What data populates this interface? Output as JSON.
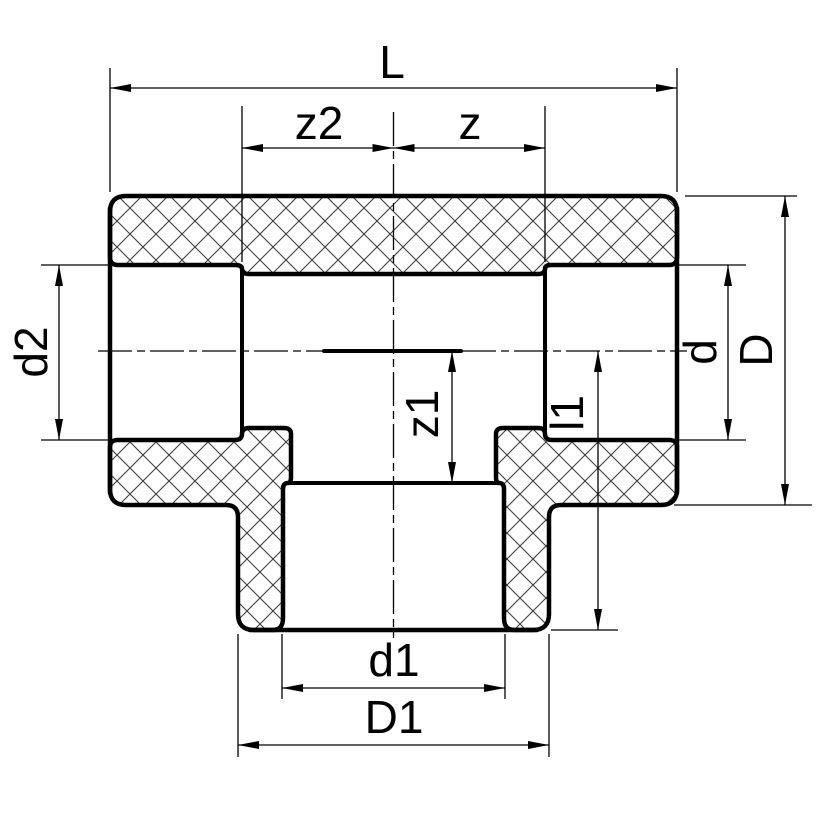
{
  "drawing": {
    "kind": "pipe-tee-fitting-cross-section",
    "colors": {
      "background": "#ffffff",
      "outline": "#000000",
      "hatch": "#3d3d3d"
    },
    "dimensions": {
      "L": {
        "label": "L"
      },
      "z2": {
        "label": "z2"
      },
      "z": {
        "label": "z"
      },
      "d2": {
        "label": "d2"
      },
      "z1": {
        "label": "z1"
      },
      "l1": {
        "label": "l1"
      },
      "d": {
        "label": "d"
      },
      "D": {
        "label": "D"
      },
      "d1": {
        "label": "d1"
      },
      "D1": {
        "label": "D1"
      }
    }
  }
}
